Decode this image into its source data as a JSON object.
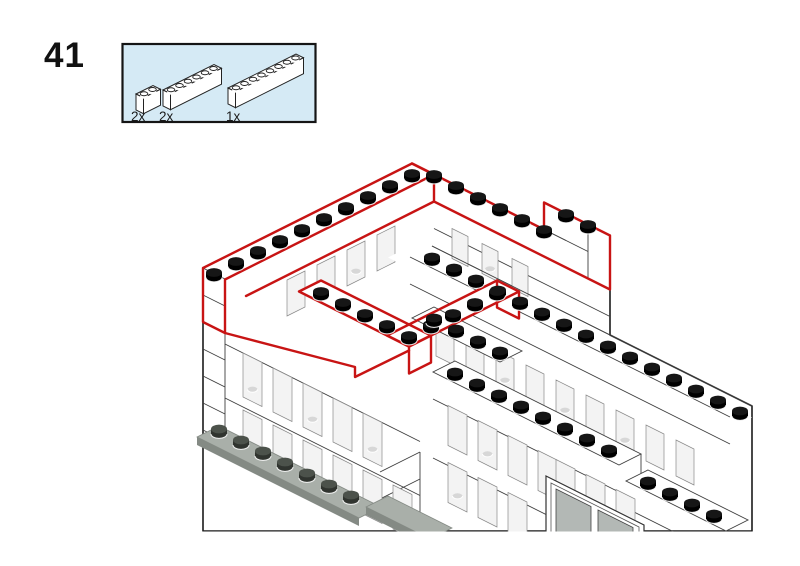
{
  "page": {
    "step_number": "41"
  },
  "parts_callout": {
    "parts": [
      {
        "name": "brick-1x2",
        "studs": 2,
        "quantity": "2x"
      },
      {
        "name": "brick-1x6",
        "studs": 6,
        "quantity": "2x"
      },
      {
        "name": "brick-1x8",
        "studs": 8,
        "quantity": "1x"
      }
    ]
  },
  "illustration": {
    "description": "isometric line drawing of white brick building with red outline marking newly placed bricks",
    "colors": {
      "highlight_red": "#c81414",
      "line": "#3f3f3f",
      "silhouette": "#1c1c1c",
      "white": "#ffffff",
      "window_glass": "#f3f3f3",
      "window_edge": "#8a8a8a",
      "ghost": "#d7d7d7",
      "plate_top": "#a9afa9",
      "plate_side": "#848a84",
      "plate_stud": "#30342f",
      "plate_stud_top": "#4c524b",
      "door_glass": "#b3b8b5",
      "stud_side": "#000000",
      "stud_top": "#161616",
      "callout_bg": "#d5eaf5",
      "callout_border": "#151515"
    }
  }
}
